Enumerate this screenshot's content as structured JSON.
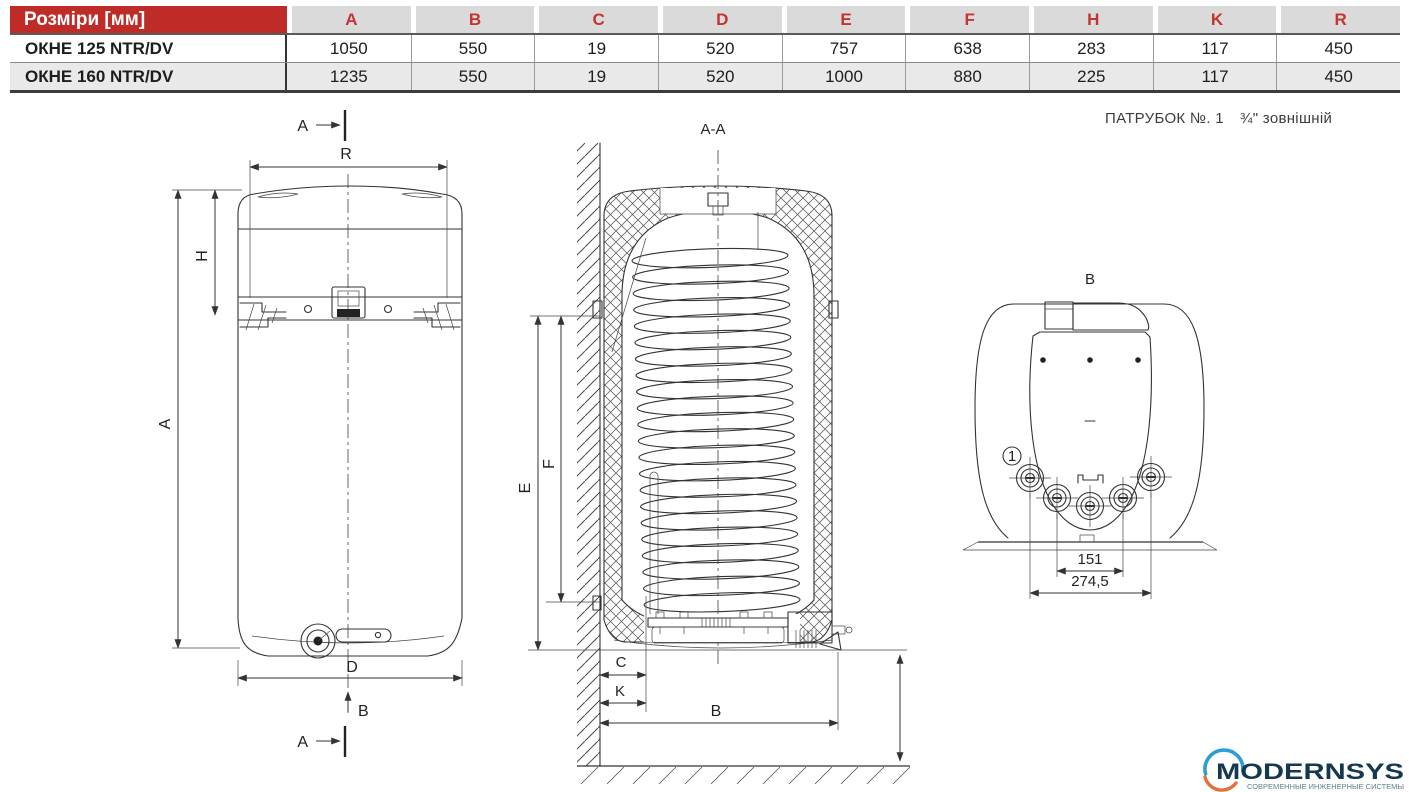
{
  "table": {
    "header_label": "Розміри [мм]",
    "columns": [
      "A",
      "B",
      "C",
      "D",
      "E",
      "F",
      "H",
      "K",
      "R"
    ],
    "rows": [
      {
        "model": "ОКНЕ 125 NTR/DV",
        "values": [
          "1050",
          "550",
          "19",
          "520",
          "757",
          "638",
          "283",
          "117",
          "450"
        ]
      },
      {
        "model": "ОКНЕ 160 NTR/DV",
        "values": [
          "1235",
          "550",
          "19",
          "520",
          "1000",
          "880",
          "225",
          "117",
          "450"
        ]
      }
    ]
  },
  "note": {
    "part1": "ПАТРУБОК №. 1",
    "part2": "¾\" зовнішній"
  },
  "front_view": {
    "section_mark_top": "A",
    "section_mark_bottom": "A",
    "dim_r": "R",
    "dim_h": "H",
    "dim_a": "A",
    "dim_d": "D",
    "dim_b": "B"
  },
  "cross_section": {
    "title": "A-A",
    "dim_e": "E",
    "dim_f": "F",
    "dim_c": "C",
    "dim_k": "K",
    "dim_b": "B"
  },
  "bottom_view": {
    "title": "B",
    "callout_1": "1",
    "dim_inner": "151",
    "dim_outer": "274,5"
  },
  "logo": {
    "name": "MODERNSYS",
    "tagline": "СОВРЕМЕННЫЕ ИНЖЕНЕРНЫЕ СИСТЕМЫ"
  },
  "colors": {
    "table_header_red": "#bf2b27",
    "column_letter_red": "#c23531",
    "row_alt_gray": "#e9e9e9",
    "logo_navy": "#14384f",
    "logo_blue": "#2a9fd6",
    "logo_orange": "#e4713a"
  }
}
